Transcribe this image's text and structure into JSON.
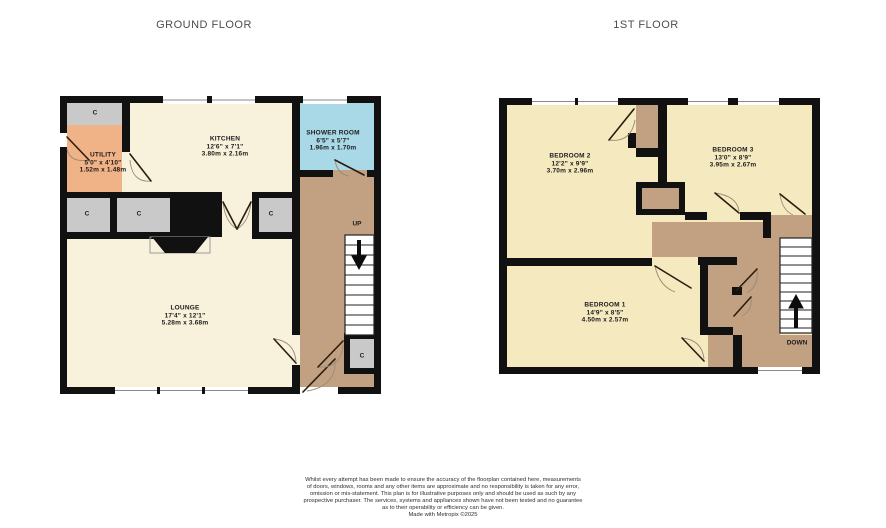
{
  "titles": {
    "ground": "GROUND FLOOR",
    "first": "1ST FLOOR"
  },
  "rooms": {
    "kitchen": {
      "name": "KITCHEN",
      "imperial": "12'6\" x 7'1\"",
      "metric": "3.80m x 2.16m"
    },
    "utility": {
      "name": "UTILITY",
      "imperial": "5'0\" x 4'10\"",
      "metric": "1.52m x 1.48m"
    },
    "shower": {
      "name": "SHOWER ROOM",
      "imperial": "6'5\" x 5'7\"",
      "metric": "1.96m x 1.70m"
    },
    "lounge": {
      "name": "LOUNGE",
      "imperial": "17'4\" x 12'1\"",
      "metric": "5.28m x 3.68m"
    },
    "bedroom1": {
      "name": "BEDROOM 1",
      "imperial": "14'9\" x 8'5\"",
      "metric": "4.50m x 2.57m"
    },
    "bedroom2": {
      "name": "BEDROOM 2",
      "imperial": "12'2\" x 9'9\"",
      "metric": "3.70m x 2.96m"
    },
    "bedroom3": {
      "name": "BEDROOM 3",
      "imperial": "13'0\" x 8'9\"",
      "metric": "3.95m x 2.67m"
    }
  },
  "labels": {
    "up": "UP",
    "down": "DOWN",
    "closet": "C"
  },
  "footer": {
    "lines": [
      "Whilst every attempt has been made to ensure the accuracy of the floorplan contained here, measurements",
      "of doors, windows, rooms and any other items are approximate and no responsibility is taken for any error,",
      "omission or mis-statement. This plan is for illustrative purposes only and should be used as such by any",
      "prospective purchaser. The services, systems and appliances shown have not been tested and no guarantee",
      "as to their operability or efficiency can be given."
    ],
    "credit": "Made with Metropix ©2025"
  },
  "colors": {
    "cream": "#f8f1db",
    "yellow": "#f5e9c0",
    "tan": "#c2a183",
    "gray": "#c9c9c9",
    "orange": "#f0b287",
    "blue": "#a9d8e6",
    "wall": "#111111"
  }
}
